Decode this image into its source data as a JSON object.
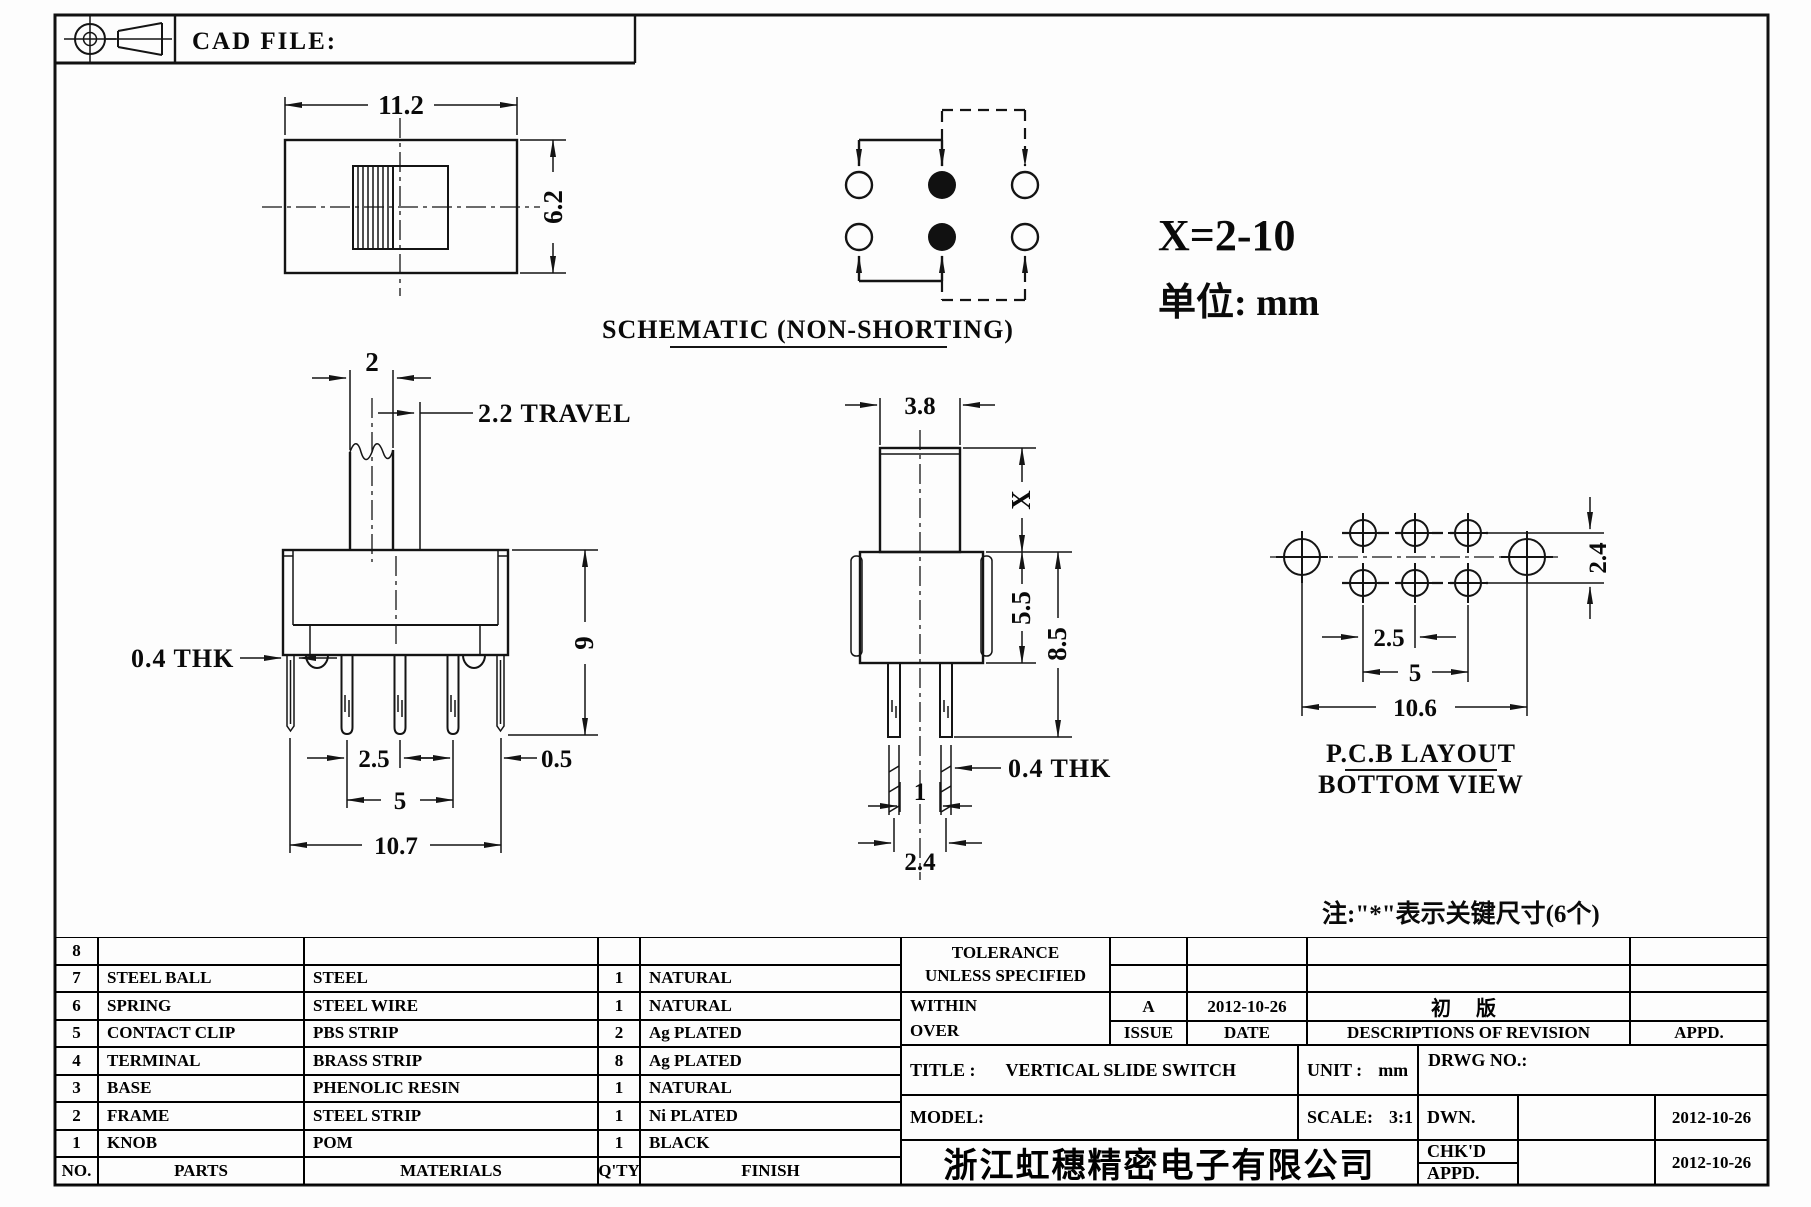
{
  "sheet": {
    "cad_file_label": "CAD FILE:"
  },
  "notes": {
    "x_range": "X=2-10",
    "unit": "单位: mm",
    "key_dims": "注:\"*\"表示关键尺寸(6个)"
  },
  "views": {
    "top": {
      "width": "11.2",
      "height": "6.2"
    },
    "front": {
      "knob_width": "2",
      "travel": "2.2 TRAVEL",
      "height": "9",
      "thickness": "0.4 THK",
      "pin_pitch": "2.5",
      "end_offset": "0.5",
      "pin_span": "5",
      "overall_width": "10.7"
    },
    "schematic": {
      "caption": "SCHEMATIC (NON-SHORTING)"
    },
    "side": {
      "knob_width": "3.8",
      "knob_height": "X",
      "body_height": "5.5",
      "overall_height": "8.5",
      "thickness": "0.4 THK",
      "pin_gap": "1",
      "pin_pitch": "2.4"
    },
    "pcb": {
      "caption1": "P.C.B LAYOUT",
      "caption2": "BOTTOM VIEW",
      "row_pitch": "2.4",
      "col_pitch": "2.5",
      "col_span": "5",
      "overall": "10.6"
    }
  },
  "parts_table": {
    "headers": {
      "no": "NO.",
      "parts": "PARTS",
      "materials": "MATERIALS",
      "qty": "Q'TY",
      "finish": "FINISH"
    },
    "rows": [
      {
        "no": "8",
        "part": "",
        "material": "",
        "qty": "",
        "finish": ""
      },
      {
        "no": "7",
        "part": "STEEL BALL",
        "material": "STEEL",
        "qty": "1",
        "finish": "NATURAL"
      },
      {
        "no": "6",
        "part": "SPRING",
        "material": "STEEL WIRE",
        "qty": "1",
        "finish": "NATURAL"
      },
      {
        "no": "5",
        "part": "CONTACT CLIP",
        "material": "PBS STRIP",
        "qty": "2",
        "finish": "Ag PLATED"
      },
      {
        "no": "4",
        "part": "TERMINAL",
        "material": "BRASS STRIP",
        "qty": "8",
        "finish": "Ag PLATED"
      },
      {
        "no": "3",
        "part": "BASE",
        "material": "PHENOLIC RESIN",
        "qty": "1",
        "finish": "NATURAL"
      },
      {
        "no": "2",
        "part": "FRAME",
        "material": "STEEL STRIP",
        "qty": "1",
        "finish": "Ni PLATED"
      },
      {
        "no": "1",
        "part": "KNOB",
        "material": "POM",
        "qty": "1",
        "finish": "BLACK"
      }
    ]
  },
  "title_block": {
    "tolerance_line1": "TOLERANCE",
    "tolerance_line2": "UNLESS  SPECIFIED",
    "within": "WITHIN",
    "over": "OVER",
    "issue_label": "ISSUE",
    "date_label": "DATE",
    "revision": {
      "issue": "A",
      "date": "2012-10-26",
      "description": "初 版"
    },
    "descriptions_label": "DESCRIPTIONS OF REVISION",
    "appd_label": "APPD.",
    "title_label": "TITLE :",
    "title_value": "VERTICAL SLIDE SWITCH",
    "unit_label": "UNIT :",
    "unit_value": "mm",
    "model_label": "MODEL:",
    "scale_label": "SCALE:",
    "scale_value": "3:1",
    "drwg_no_label": "DRWG NO.:",
    "dwn_label": "DWN.",
    "dwn_date": "2012-10-26",
    "chkd_label": "CHK'D",
    "appd2_label": "APPD.",
    "chkd_appd_date": "2012-10-26",
    "company": "浙江虹穗精密电子有限公司"
  }
}
